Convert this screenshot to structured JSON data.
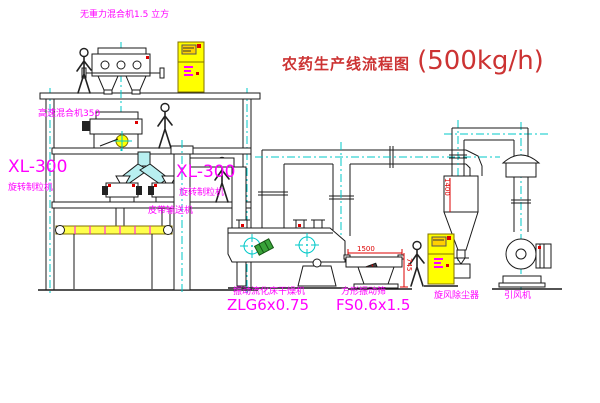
{
  "title": {
    "text": "农药生产线流程图",
    "capacity": "(500kg/h)"
  },
  "labels": {
    "gravity_mixer": "无重力混合机1.5 立方",
    "high_speed_mixer": "高速混合机350",
    "granulator_left_model": "XL-300",
    "granulator_left_name": "旋转制粒机",
    "granulator_right_model": "XL-300",
    "granulator_right_name": "旋转制粒机",
    "belt_conveyor": "皮带输送机",
    "dryer_name": "振动流化床干燥机",
    "dryer_model": "ZLG6x0.75",
    "sieve_name": "方形振动筛",
    "sieve_model": "FS0.6x1.5",
    "cyclone": "旋风除尘器",
    "fan": "引风机"
  },
  "dimensions": {
    "sieve_length": "1500",
    "sieve_height": "745",
    "cyclone_dia": "1400"
  },
  "colors": {
    "label": "#ff00ff",
    "title": "#cc3333",
    "centerline": "#00c8c8",
    "cabinet": "#ffff00",
    "dimension": "#dd0000"
  }
}
